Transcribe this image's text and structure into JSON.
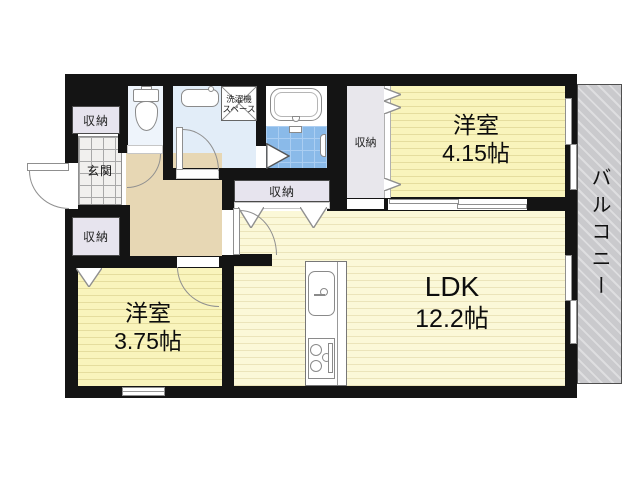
{
  "floorplan": {
    "balcony": {
      "label": "バルコニー"
    },
    "entrance": {
      "label": "玄関"
    },
    "bedroom1": {
      "name": "洋室",
      "size": "4.15帖"
    },
    "bedroom2": {
      "name": "洋室",
      "size": "3.75帖"
    },
    "ldk": {
      "name": "LDK",
      "size": "12.2帖"
    },
    "storage_top_left": {
      "label": "収納"
    },
    "storage_bottom_left": {
      "label": "収納"
    },
    "storage_ldk_wall": {
      "label": "収納"
    },
    "storage_bedroom1": {
      "label": "収納"
    },
    "laundry_space": {
      "line1": "洗濯機",
      "line2": "スペース"
    },
    "colors": {
      "wall": "#141414",
      "bedroom_floor": "#f9f4bc",
      "ldk_floor": "#fbf8d8",
      "hall_floor": "#e7d7b4",
      "entrance_tile": "#f1f0ee",
      "storage_fill": "#e7e4ee",
      "bathroom_tile": "#8abae9",
      "washroom_floor": "#e2edf8",
      "toilet_floor": "#eef4fb",
      "balcony_fill": "#cacacd"
    }
  }
}
